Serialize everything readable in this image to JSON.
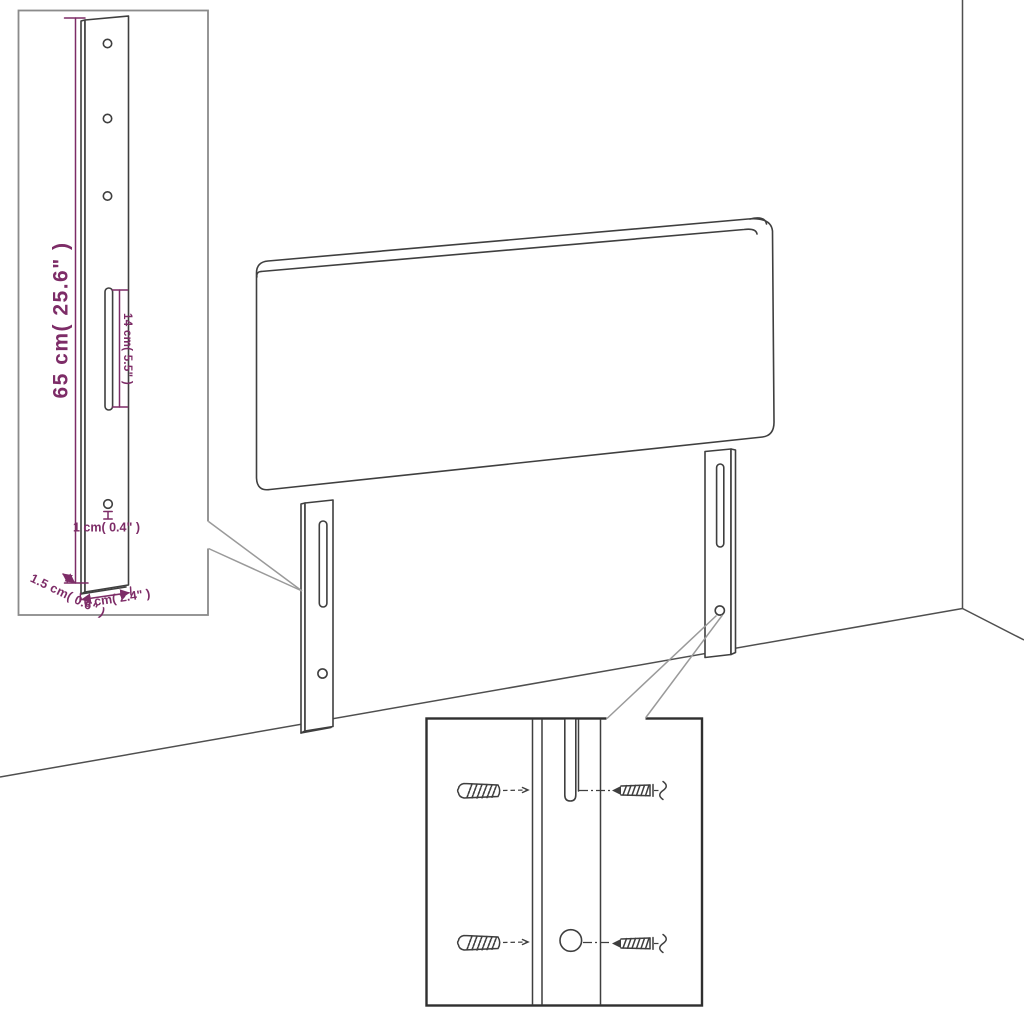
{
  "image_type": "furniture dimension diagram (headboard with mounting legs)",
  "colors": {
    "background": "#ffffff",
    "line": "#3f3f3f",
    "wall": "#4f4f4f",
    "callout": "#9a9a9a",
    "dimension": "#7d2c67",
    "inset_border_light": "#8b8b8b",
    "inset_border_dark": "#2f2f2f"
  },
  "leg_detail_inset": {
    "labels": {
      "height": "65 cm( 25.6\" )",
      "slot_length": "14 cm( 5.5\" )",
      "hole_diameter": "1 cm( 0.4\" )",
      "thickness": "1.5 cm( 0.6\" )",
      "width": "6 cm( 2.4\" )"
    }
  },
  "hardware_detail_inset": {
    "icons": [
      "wall-plug-icon",
      "screw-icon"
    ]
  }
}
